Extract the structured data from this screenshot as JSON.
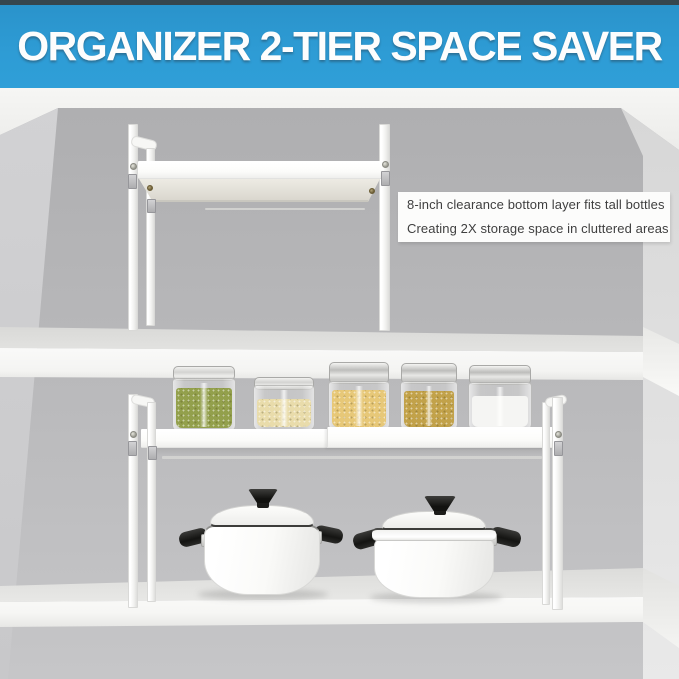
{
  "banner": {
    "title": "ORGANIZER 2-TIER SPACE SAVER",
    "background_color": "#2e9cd5",
    "top_strip_color": "#36464e",
    "text_color": "#fdfdfd"
  },
  "annotation": {
    "line1": "8-inch clearance bottom layer fits tall bottles",
    "line2": "Creating 2X storage space in cluttered areas",
    "background_color": "#fcfcfb",
    "text_color": "#3f3f3f"
  },
  "palette": {
    "back_wall": "#b6b6b8",
    "left_wall": "#cbcbcd",
    "right_wall": "#e2e2e2",
    "ceiling": "#f3f3f1",
    "shelf_white": "#fafaf8",
    "organizer_white": "#fcfcfa",
    "pot_white": "#fbfbf9",
    "pot_handle_black": "#1c1c1a"
  },
  "jars": [
    {
      "id": "jar-1",
      "contents": "green mung beans",
      "color": "#93a04c",
      "lid": "glass"
    },
    {
      "id": "jar-2",
      "contents": "pale grains",
      "color": "#e9dcab",
      "lid": "glass"
    },
    {
      "id": "jar-3",
      "contents": "yellow millet",
      "color": "#e7c878",
      "lid": "metal"
    },
    {
      "id": "jar-4",
      "contents": "golden grains",
      "color": "#c2a24a",
      "lid": "metal"
    },
    {
      "id": "jar-5",
      "contents": "white salt",
      "color": "#f5f5f3",
      "lid": "metal"
    }
  ],
  "pots": [
    {
      "id": "pot-left",
      "description": "white pot with lid and black knob"
    },
    {
      "id": "pot-right",
      "description": "white pot with lid and black knob"
    }
  ]
}
